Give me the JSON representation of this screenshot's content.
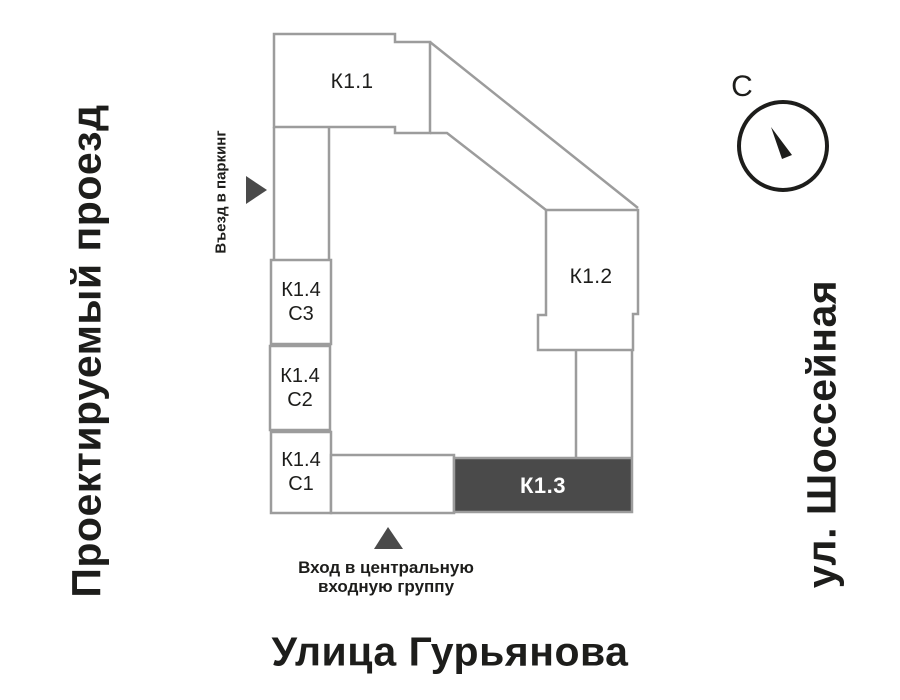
{
  "colors": {
    "line": "#9c9c9c",
    "dark": "#4a4a4a",
    "ink": "#1d1d1b",
    "label_on_dark": "#ffffff",
    "background": "#ffffff"
  },
  "streets": {
    "left": "Проектируемый проезд",
    "right": "ул. Шоссейная",
    "bottom": "Улица Гурьянова"
  },
  "compass": {
    "north_label": "С"
  },
  "buildings": {
    "k11": {
      "label": "К1.1"
    },
    "k12": {
      "label": "К1.2"
    },
    "k13": {
      "label": "К1.3"
    },
    "k14c3": {
      "label": "К1.4",
      "sub": "С3"
    },
    "k14c2": {
      "label": "К1.4",
      "sub": "С2"
    },
    "k14c1": {
      "label": "К1.4",
      "sub": "С1"
    }
  },
  "annotations": {
    "parking": "Въезд в паркинг",
    "entrance_line1": "Вход в центральную",
    "entrance_line2": "входную группу"
  }
}
